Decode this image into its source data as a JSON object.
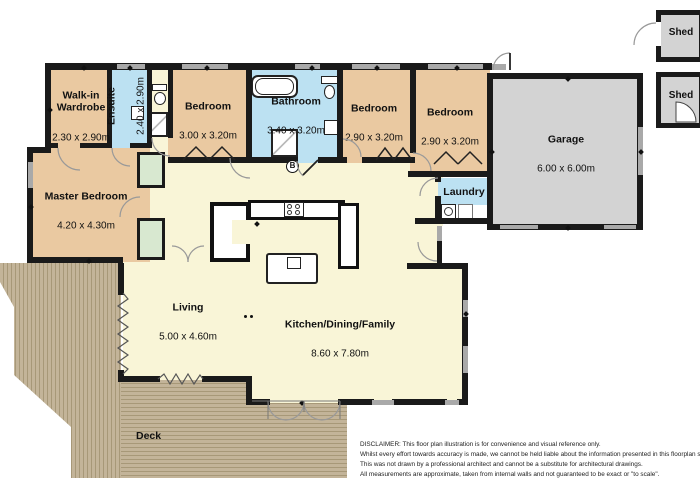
{
  "rooms": {
    "walkin": {
      "name": "Walk-in\nWardrobe",
      "dims": "2.30 x 2.90m"
    },
    "ensuite": {
      "name": "Ensuite",
      "dims": "2.40 x 2.90m"
    },
    "bedroom2": {
      "name": "Bedroom",
      "dims": "3.00 x 3.20m"
    },
    "bathroom": {
      "name": "Bathroom",
      "dims": "3.40 x 3.20m"
    },
    "bedroom3": {
      "name": "Bedroom",
      "dims": "2.90 x 3.20m"
    },
    "bedroom4": {
      "name": "Bedroom",
      "dims": "2.90 x 3.20m"
    },
    "master": {
      "name": "Master Bedroom",
      "dims": "4.20 x 4.30m"
    },
    "laundry": {
      "name": "Laundry"
    },
    "garage": {
      "name": "Garage",
      "dims": "6.00 x 6.00m"
    },
    "living": {
      "name": "Living",
      "dims": "5.00 x 4.60m"
    },
    "kitchen": {
      "name": "Kitchen/Dining/Family",
      "dims": "8.60 x 7.80m"
    },
    "deck": {
      "name": "Deck"
    },
    "shed_top": {
      "name": "Shed"
    },
    "shed_bottom": {
      "name": "Shed"
    }
  },
  "symbols": {
    "b_marker": "B"
  },
  "disclaimer": {
    "lines": [
      "DISCLAIMER: This floor plan illustration is for convenience and visual reference only.",
      "Whilst every effort towards accuracy is made, we cannot be held liable about the information presented in this floorplan sketch.",
      "This was not drawn by a professional architect and cannot be a substitute for architectural drawings.",
      "All measurements are approximate, taken from internal walls and not guaranteed to be exact or \"to scale\"."
    ]
  },
  "colors": {
    "bedroom_tan": "#eac9a1",
    "wet_area_blue": "#bce1f2",
    "living_cream": "#f9f5d7",
    "closet_green": "#d8e8d0",
    "garage_gray": "#d3d3d3",
    "wall_black": "#1a1a1a",
    "window_gray": "#a9a9a9",
    "deck_wood": "#c3b499"
  }
}
